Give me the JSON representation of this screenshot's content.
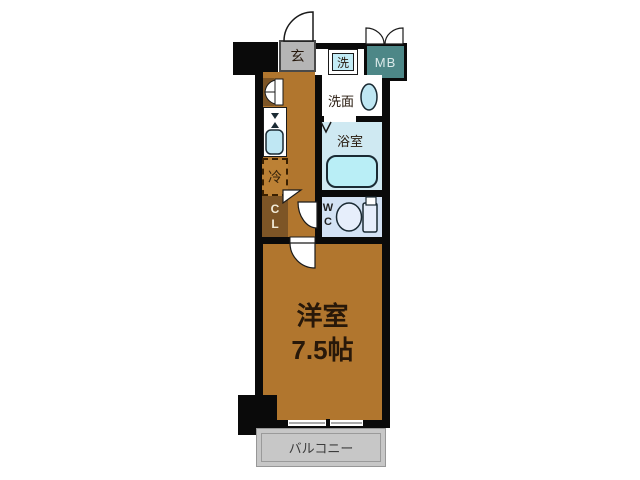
{
  "title": "apartment-floorplan",
  "rooms": {
    "entrance": {
      "label": "玄"
    },
    "washer": {
      "label": "洗"
    },
    "meter_box": {
      "label": "MB"
    },
    "washroom": {
      "label": "洗面"
    },
    "bathroom": {
      "label": "浴室"
    },
    "toilet": {
      "line1": "W",
      "line2": "C"
    },
    "closet": {
      "line1": "C",
      "line2": "L"
    },
    "fridge": {
      "label": "冷"
    },
    "main_room": {
      "name": "洋室",
      "size": "7.5帖"
    },
    "balcony": {
      "label": "バルコニー"
    }
  },
  "colors": {
    "wall": "#0a0a0a",
    "floor_wood": "#b1762e",
    "closet_brown": "#7d5526",
    "entrance_gray": "#b5b5b5",
    "washer_cyan": "#c2ecf6",
    "meter_box_teal": "#4d8787",
    "bath_blue": "#cfe9f2",
    "tub_cyan": "#b9eef6",
    "fixture_blue": "#bfe7f3",
    "wc_blue": "#d3e2f4",
    "toilet_fill": "#e6eefb",
    "balcony_gray": "#c7c7c7",
    "text_dark": "#26180c"
  }
}
